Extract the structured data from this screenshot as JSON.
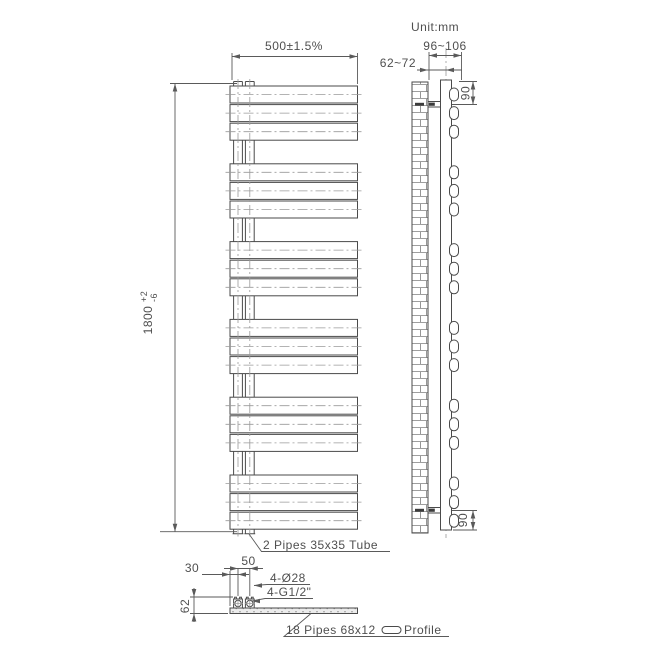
{
  "unit_label": "Unit:mm",
  "front_view": {
    "width_dim": "500±1.5%",
    "height_dim_value": "1800",
    "height_tol_plus": "+2",
    "height_tol_minus": "-6",
    "pipes_note": "2 Pipes 35x35 Tube",
    "bar_groups": 6,
    "bars_per_group": 3
  },
  "side_view": {
    "wall_clearance_dim": "62~72",
    "overall_depth_dim": "96~106",
    "top_bracket_offset_dim": "90",
    "bottom_bracket_offset_dim": "90"
  },
  "bottom_detail": {
    "edge_offset_dim": "30",
    "pipe_spacing_dim": "50",
    "depth_dim": "62",
    "holes_note": "4-Ø28",
    "thread_note": "4-G1/2\"",
    "profile_note_prefix": "18 Pipes 68x12",
    "profile_note_suffix": "Profile"
  },
  "colors": {
    "background": "#ffffff",
    "outline": "#4a4a4a",
    "dimension": "#5a5a5a",
    "centerline": "#9a9a9a",
    "text": "#4f4f4f"
  }
}
